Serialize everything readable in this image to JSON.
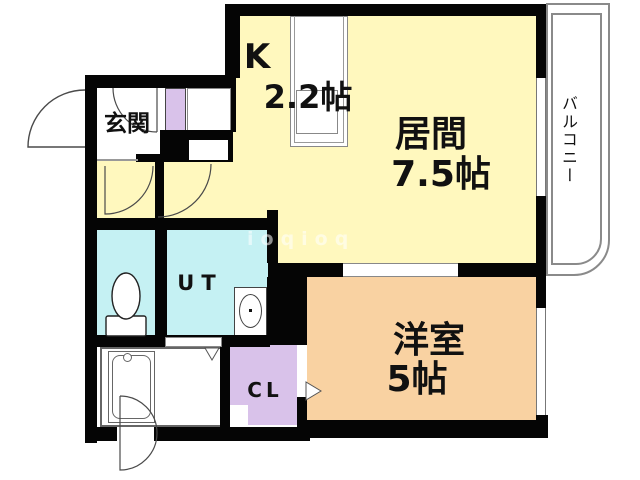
{
  "floorplan": {
    "rooms": {
      "kitchen": {
        "label": "K",
        "size": "2.2帖"
      },
      "living": {
        "label": "居間",
        "size": "7.5帖"
      },
      "western": {
        "label": "洋室",
        "size": "5帖"
      },
      "entrance": {
        "label": "玄関"
      },
      "utility": {
        "label": "UT"
      },
      "closet": {
        "label": "CL"
      },
      "balcony": {
        "label": "バルコニー"
      }
    },
    "watermark": "ioqioq",
    "colors": {
      "ldk_floor": "#FFF8BE",
      "wet_area_floor": "#C5F1F3",
      "western_room_floor": "#F9D2A2",
      "closet_floor": "#D9C2EA",
      "wall": "#000000",
      "balcony_line": "#8A8A8A"
    }
  }
}
